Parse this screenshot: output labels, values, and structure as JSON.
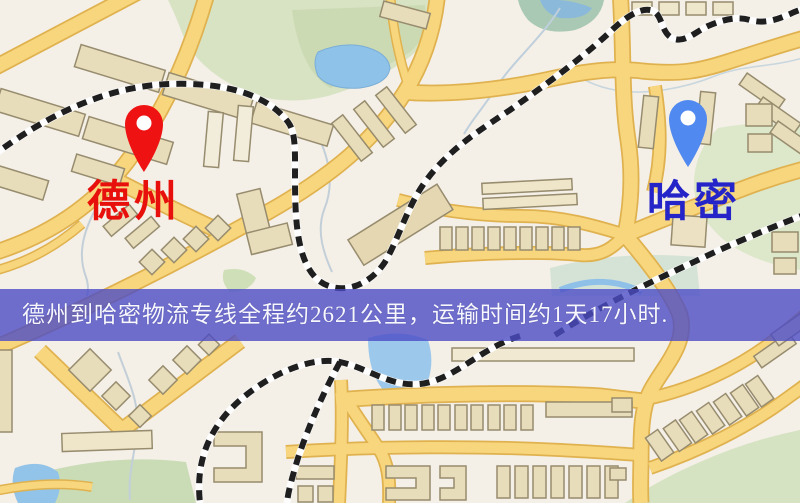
{
  "map": {
    "origin_label": "德州",
    "destination_label": "哈密",
    "origin_label_color": "#e8100c",
    "destination_label_color": "#2424c8",
    "origin_pin": "red-map-pin-icon",
    "destination_pin": "blue-map-pin-icon",
    "palette": {
      "background": "#f4efe7",
      "road_fill": "#f7d67e",
      "road_casing": "#e0b24f",
      "park": "#d8e3c4",
      "water": "#90c2e8",
      "building": "#e8ddbb",
      "railway": "#1f1f1f",
      "origin_pin_color": "#ee1312",
      "destination_pin_color": "#5089ef"
    }
  },
  "banner": {
    "text": "德州到哈密物流专线全程约2621公里，运输时间约1天17小时.",
    "background": "#4c4cc6",
    "text_color": "#f7f7fd"
  }
}
